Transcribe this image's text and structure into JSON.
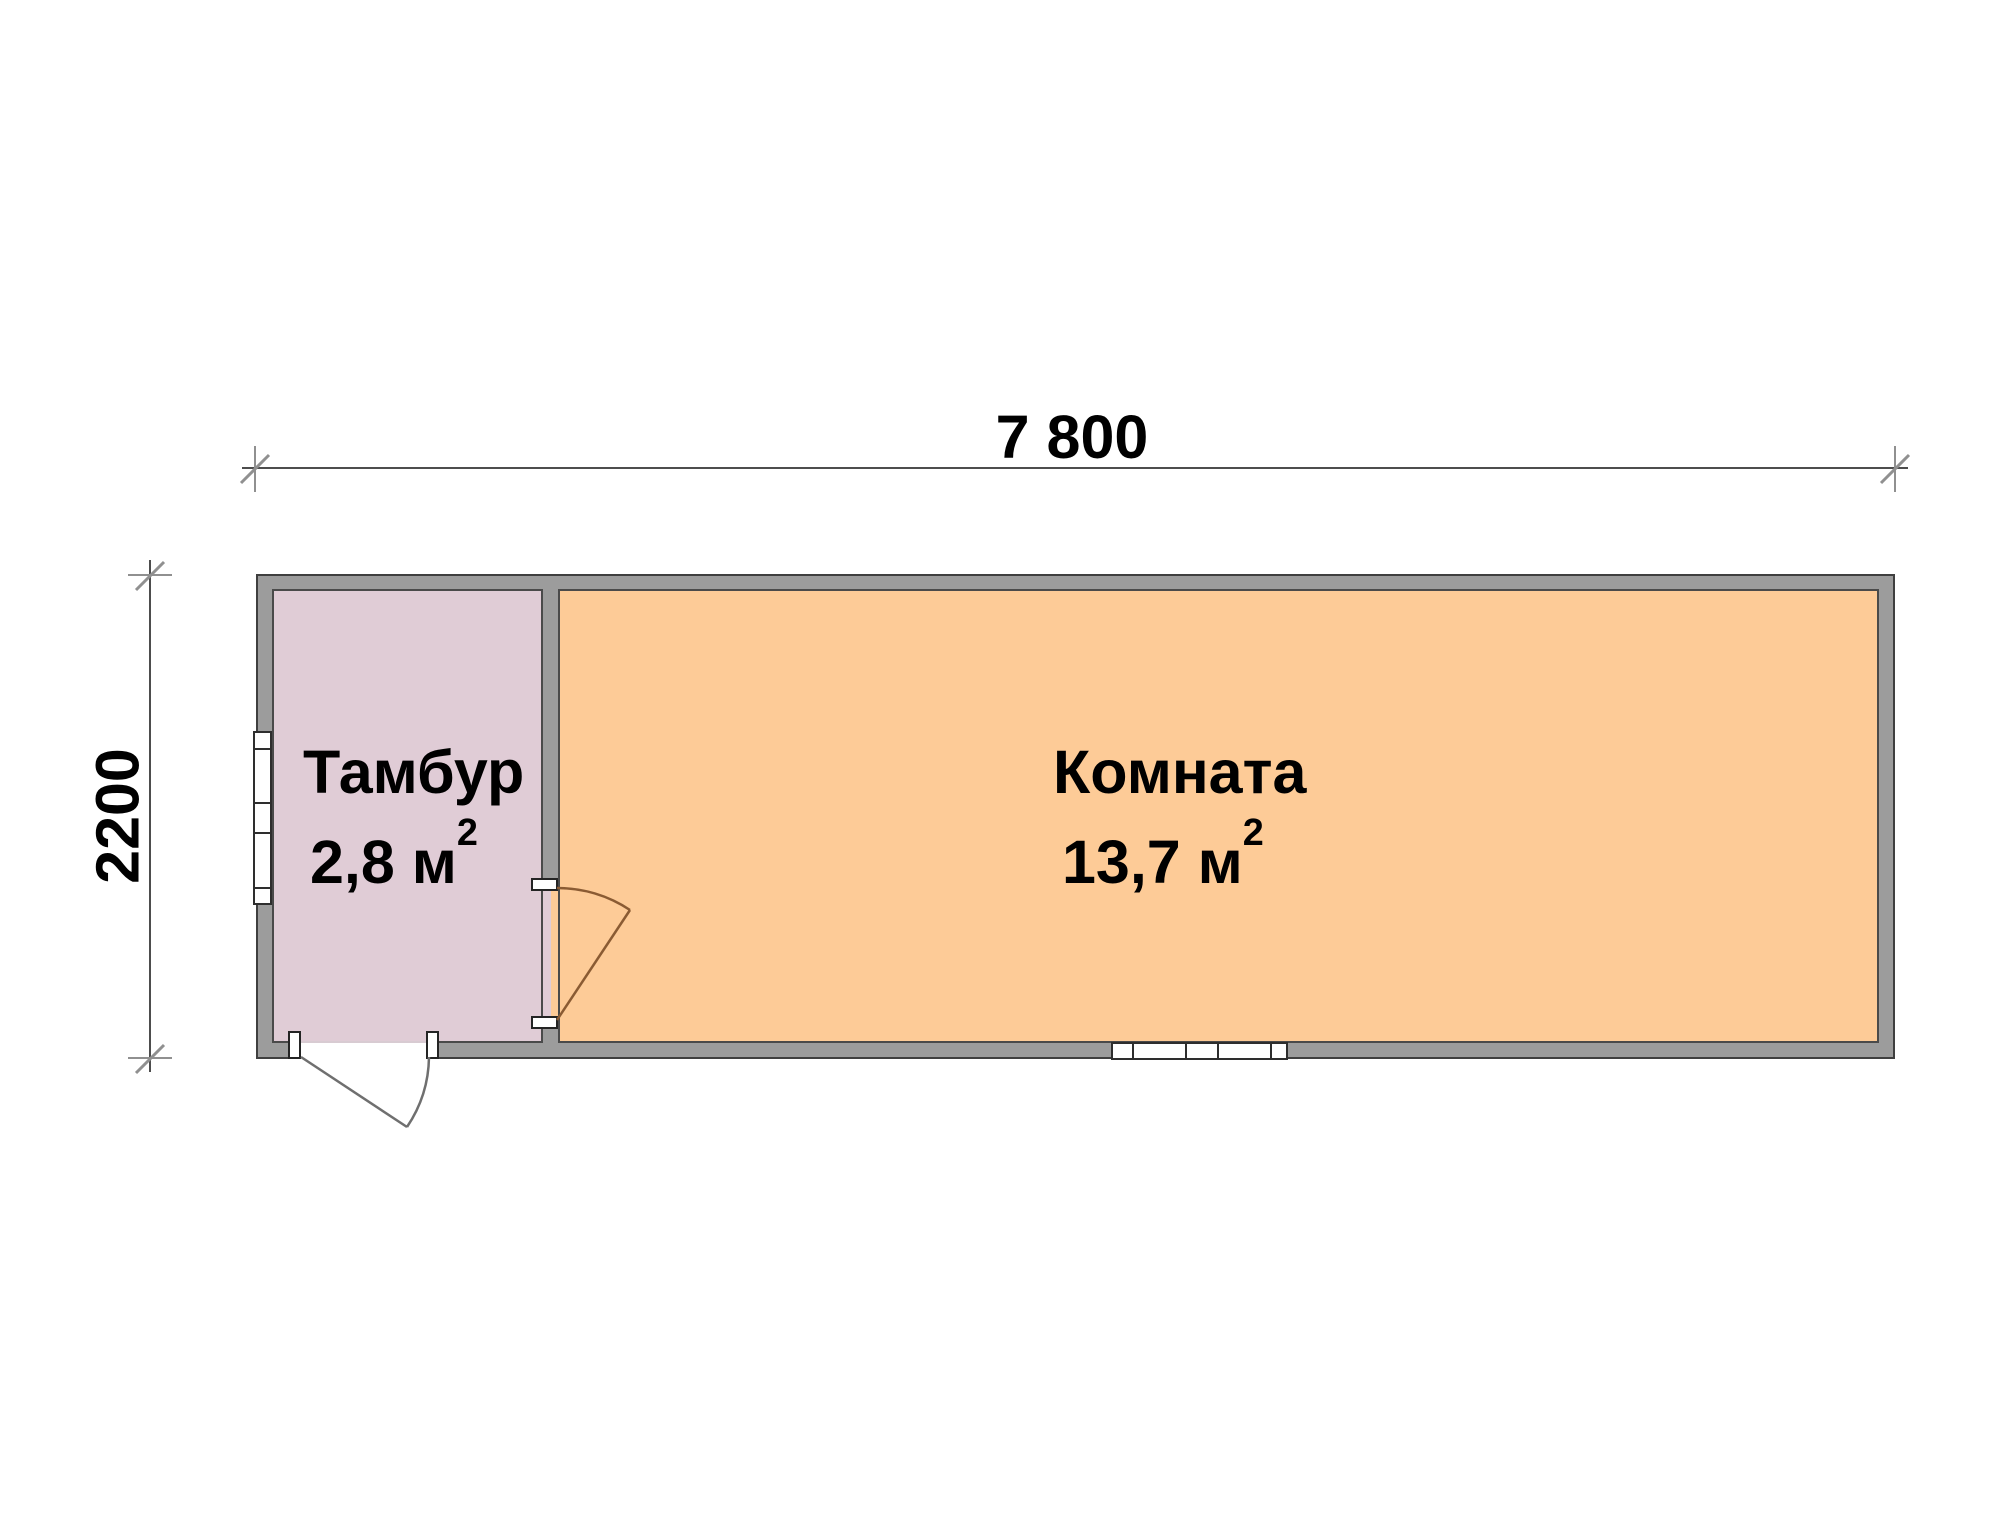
{
  "plan": {
    "type_label": "floor-plan",
    "dimensions": {
      "top": {
        "label": "7 800"
      },
      "left": {
        "label": "2200"
      }
    },
    "rooms": [
      {
        "id": "tambur",
        "name": "Тамбур",
        "area_text": "2,8 м",
        "area_sup": "2",
        "fill": "#e0ccd6"
      },
      {
        "id": "komnata",
        "name": "Комната",
        "area_text": "13,7 м",
        "area_sup": "2",
        "fill": "#fdcb97"
      }
    ],
    "colors": {
      "background": "#ffffff",
      "wall_fill": "#9c9c9c",
      "wall_outline": "#3f3f3f",
      "tambur_fill": "#e0ccd6",
      "komnata_fill": "#fdcb97",
      "dim_line": "#4d4d4d",
      "dim_tick": "#909090",
      "door_exterior_line": "#6f6f6f",
      "door_interior_line": "#8a5b33",
      "window_frame": "#2e2e2e",
      "threshold": "#d8cbd2"
    }
  }
}
